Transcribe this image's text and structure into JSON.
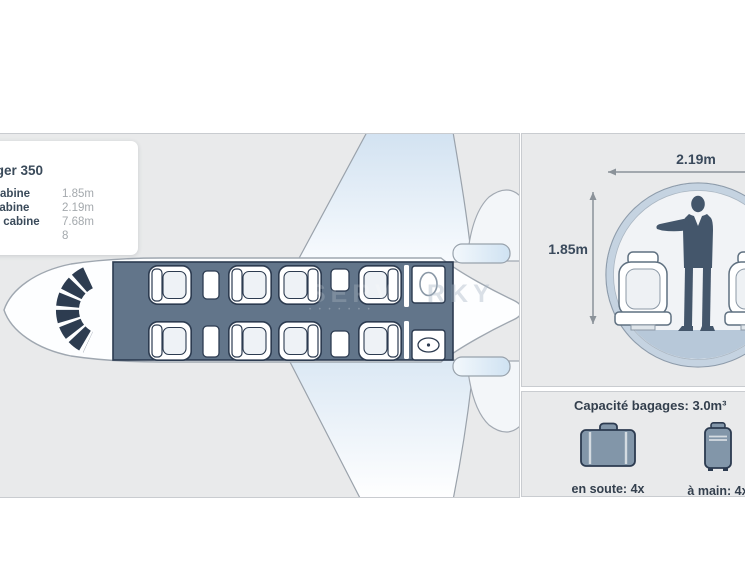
{
  "info_card": {
    "title": "Challenger 350",
    "rows": [
      {
        "label": "Hauteur cabine",
        "value": "1.85m"
      },
      {
        "label": "Largeur cabine",
        "value": "2.19m"
      },
      {
        "label": "Longueur cabine",
        "value": "7.68m"
      },
      {
        "label": "Passagers",
        "value": "8"
      }
    ]
  },
  "cross_section": {
    "width_label": "2.19m",
    "height_label": "1.85m"
  },
  "baggage": {
    "heading": "Capacité bagages: 3.0m³",
    "hold_label": "en soute: 4x",
    "hand_label": "à main: 4x"
  },
  "watermark": {
    "fragment_1": "SERV",
    "fragment_2": "RKY"
  },
  "floorplan": {
    "cabin_seats": 8,
    "lavatory": "toilet and sink at rear cabin"
  },
  "colors": {
    "panel_bg": "#e9eaeb",
    "cabin_slate": "#62758a",
    "dark_navy": "#2c3b50",
    "wing_blue": "#d7e4f1",
    "icon_fill": "#8296a9",
    "text_dark": "#3a4a5c",
    "value_gray": "#a4a9ad"
  }
}
